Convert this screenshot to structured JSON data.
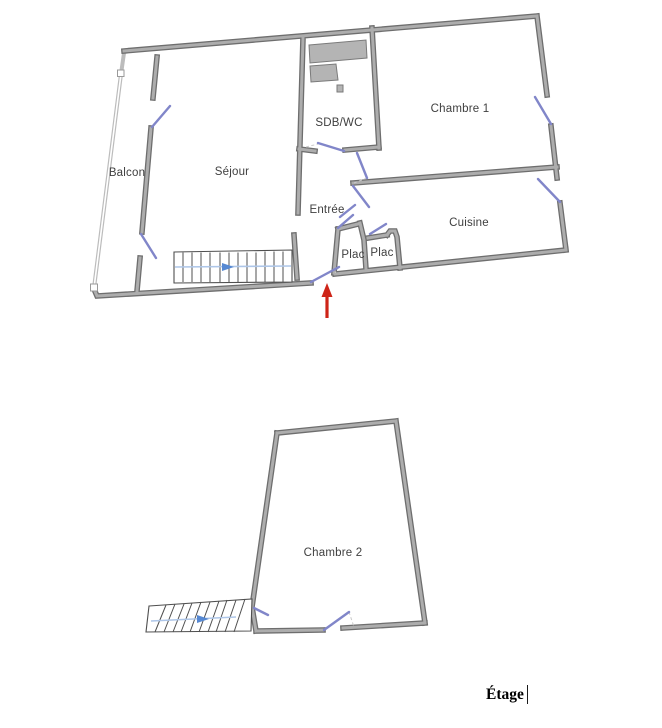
{
  "caption": {
    "text": "Étage"
  },
  "upper_floor": {
    "rooms": {
      "balcon": "Balcon",
      "sejour": "Séjour",
      "sdb_wc": "SDB/WC",
      "chambre1": "Chambre 1",
      "entree": "Entrée",
      "cuisine": "Cuisine",
      "plac_left": "Plac",
      "plac_right": "Plac"
    }
  },
  "lower_floor": {
    "rooms": {
      "chambre2": "Chambre 2"
    }
  },
  "icons": {
    "entry_arrow": "red-up-arrow-icon",
    "stair_direction_upper": "blue-right-arrow-icon",
    "stair_direction_lower": "blue-right-arrow-icon",
    "text_cursor": "text-cursor"
  },
  "colors": {
    "wall_edge": "#6e6e6e",
    "wall_fill": "#adadad",
    "balcony_wall": "#bcbcbc",
    "door_window": "#8186c9",
    "fixture_fill": "#b4b4b4",
    "fixture_edge": "#7a7a7a",
    "stair_line": "#4f4f4f",
    "walk_line": "#aec6e8",
    "walk_arrow": "#5688d2",
    "entry_arrow": "#ce2418",
    "room_label": "#3f3f3f",
    "caption_text": "#000000"
  }
}
